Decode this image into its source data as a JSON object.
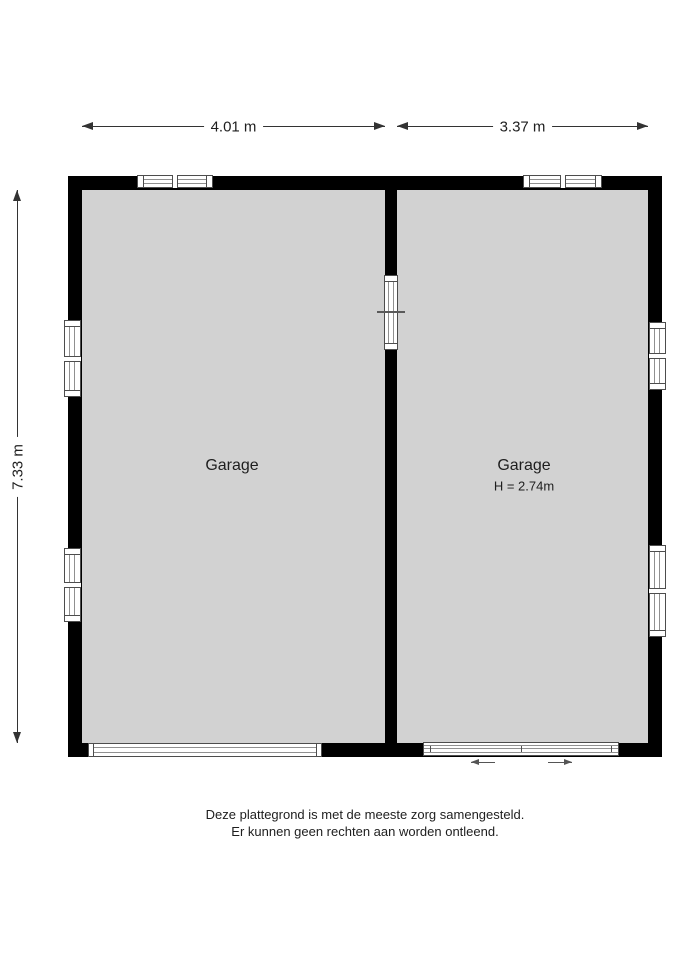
{
  "colors": {
    "background": "#ffffff",
    "wall": "#000000",
    "floor": "#d2d2d2",
    "dimension_line": "#333333",
    "window_frame": "#4d4d4d",
    "glazing_line": "#909090",
    "text": "#1e1e1e"
  },
  "dimensions": {
    "top_left_width": "4.01 m",
    "top_right_width": "3.37 m",
    "left_height": "7.33 m"
  },
  "rooms": {
    "left": {
      "label": "Garage"
    },
    "right": {
      "label": "Garage",
      "ceiling_height": "H = 2.74m"
    }
  },
  "footer": {
    "line1": "Deze plattegrond is met de meeste zorg samengesteld.",
    "line2": "Er kunnen geen rechten aan worden ontleend."
  }
}
